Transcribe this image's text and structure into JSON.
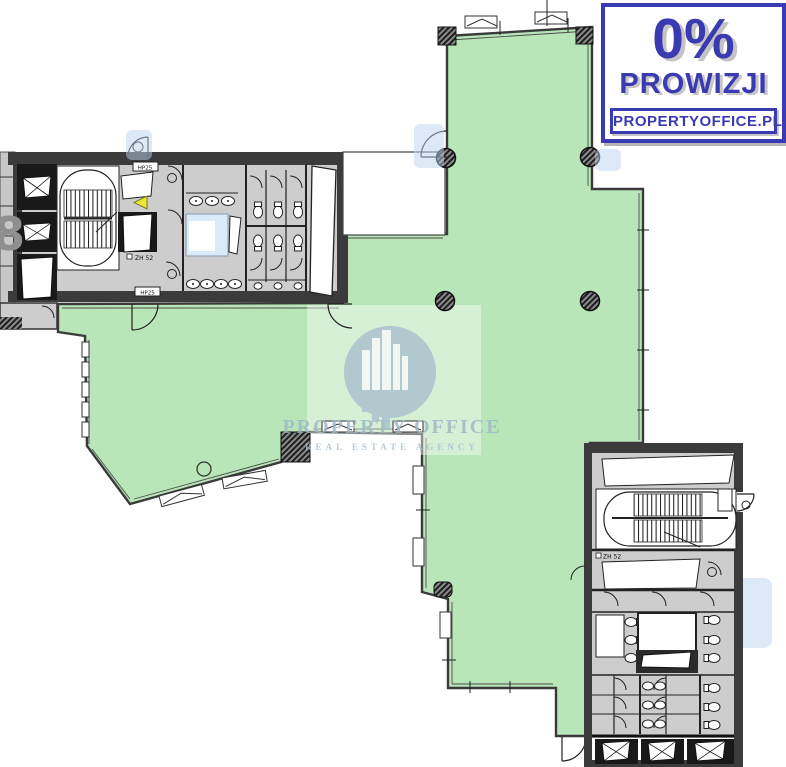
{
  "badge": {
    "percent": "0%",
    "commission_label": "PROWIZJI",
    "website": "PROPERTYOFFICE.PL"
  },
  "watermark": {
    "title": "PROPERTY OFFICE",
    "subtitle": "REAL ESTATE AGENCY",
    "logo": "buildings-in-circle-icon"
  },
  "labels": {
    "floor_number": "8",
    "hp25_top": "HP25",
    "hp25_bottom": "HP25",
    "zh52_core1": "ZH 52",
    "zh52_core2": "ZH 52"
  },
  "colors": {
    "open_space_green": "#b8e6b9",
    "badge_blue": "#3a3ab2",
    "wall_dark": "#3b3b3b",
    "wet_room_gray": "#cdcdcd",
    "shaft_blue": "#d9eaf8",
    "watermark_bluegray": "#a8c0cd",
    "marker_yellow": "#e8e838"
  }
}
